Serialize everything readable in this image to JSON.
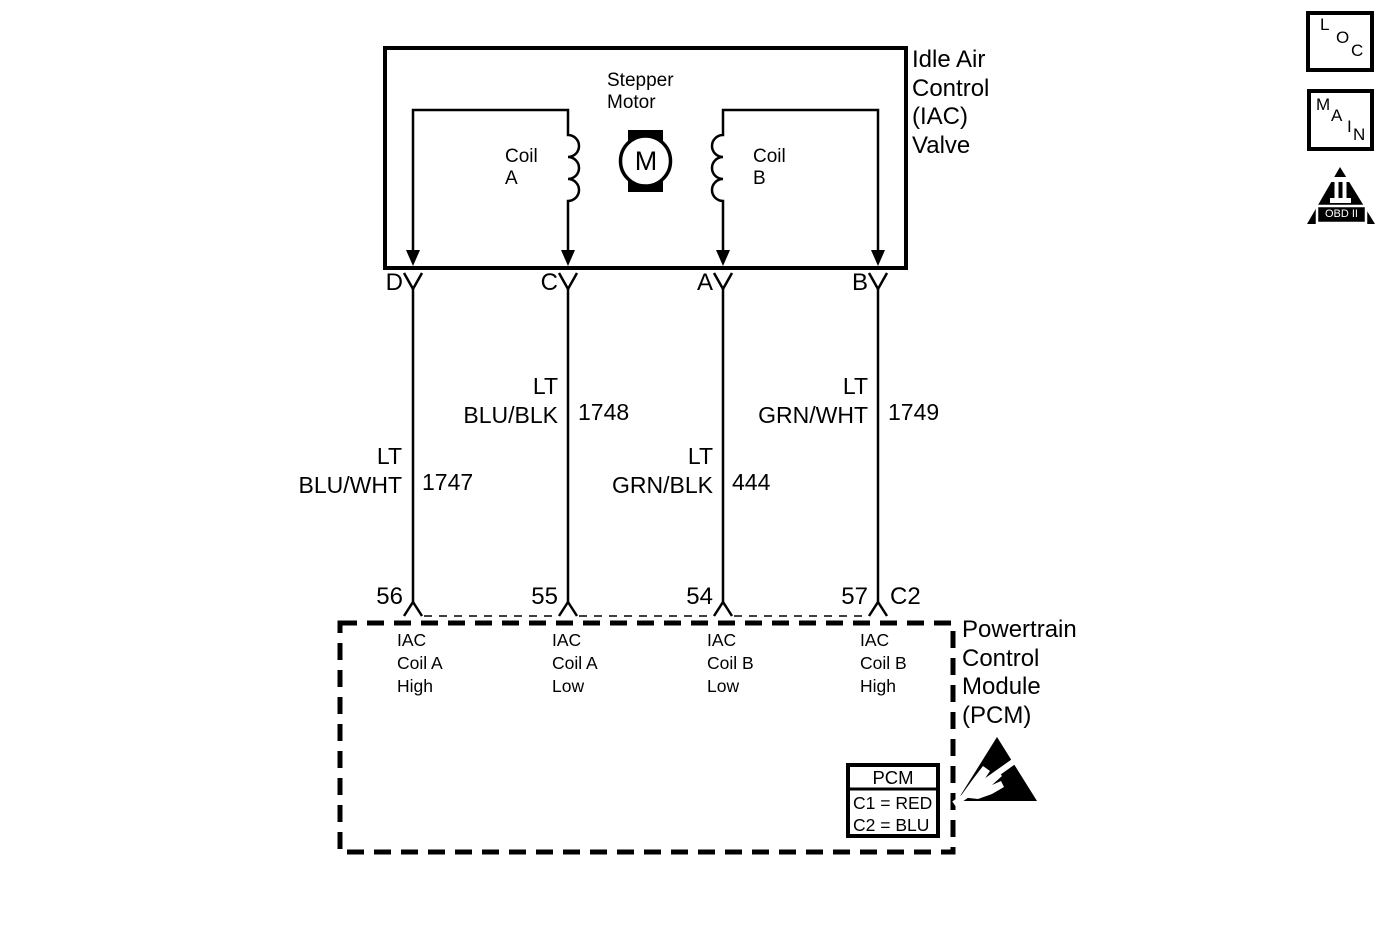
{
  "diagram": {
    "title": "Idle Air\nControl\n(IAC)\nValve",
    "component": {
      "stepper_motor_label": "Stepper\nMotor",
      "motor_symbol": "M",
      "coil_a_label": "Coil\nA",
      "coil_b_label": "Coil\nB"
    },
    "wires": [
      {
        "pin": "D",
        "color": "LT\nBLU/WHT",
        "circuit": "1747",
        "pcm_pin": "56",
        "function": "IAC\nCoil A\nHigh"
      },
      {
        "pin": "C",
        "color": "LT\nBLU/BLK",
        "circuit": "1748",
        "pcm_pin": "55",
        "function": "IAC\nCoil A\nLow"
      },
      {
        "pin": "A",
        "color": "LT\nGRN/BLK",
        "circuit": "444",
        "pcm_pin": "54",
        "function": "IAC\nCoil B\nLow"
      },
      {
        "pin": "B",
        "color": "LT\nGRN/WHT",
        "circuit": "1749",
        "pcm_pin": "57",
        "function": "IAC\nCoil B\nHigh"
      }
    ],
    "pcm": {
      "title": "Powertrain\nControl\nModule\n(PCM)",
      "connector_label": "C2",
      "legend": {
        "title": "PCM",
        "rows": [
          "C1 = RED",
          "C2 = BLU"
        ]
      }
    },
    "badges": {
      "loc": [
        "L",
        "O",
        "C"
      ],
      "main": [
        "M",
        "A",
        "I",
        "N"
      ],
      "obd": "OBD II"
    },
    "colors": {
      "line": "#000000",
      "background": "#ffffff"
    }
  }
}
